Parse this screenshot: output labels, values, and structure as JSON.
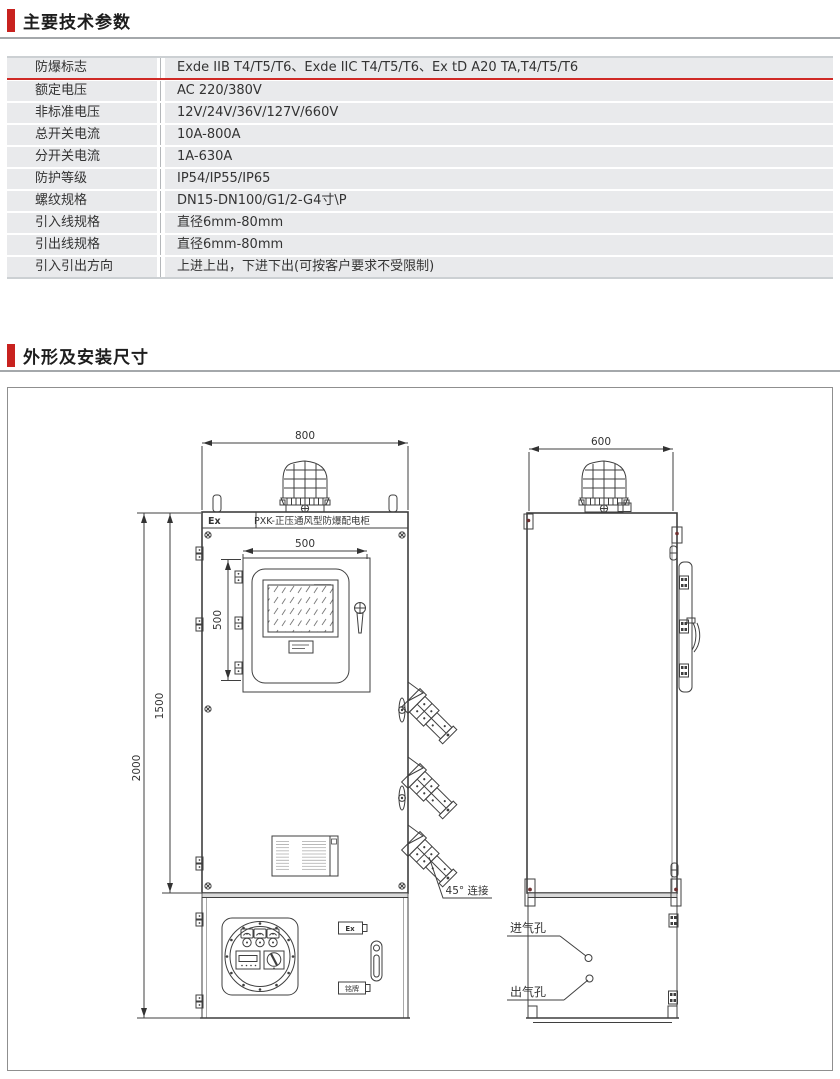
{
  "colors": {
    "accent_red": "#c8221f",
    "row_bg": "#e9eaec",
    "line": "#3f3f3f"
  },
  "section1": {
    "title": "主要技术参数"
  },
  "section2": {
    "title": "外形及安装尺寸"
  },
  "spec_table": {
    "rows": [
      {
        "label": "防爆标志",
        "value": "Exde IIB T4/T5/T6、Exde IIC T4/T5/T6、Ex tD  A20 TA,T4/T5/T6"
      },
      {
        "label": "额定电压",
        "value": "AC 220/380V"
      },
      {
        "label": "非标准电压",
        "value": "12V/24V/36V/127V/660V"
      },
      {
        "label": "总开关电流",
        "value": "10A-800A"
      },
      {
        "label": "分开关电流",
        "value": "1A-630A"
      },
      {
        "label": "防护等级",
        "value": "IP54/IP55/IP65"
      },
      {
        "label": "螺纹规格",
        "value": "DN15-DN100/G1/2-G4寸\\P"
      },
      {
        "label": "引入线规格",
        "value": "直径6mm-80mm"
      },
      {
        "label": "引出线规格",
        "value": "直径6mm-80mm"
      },
      {
        "label": "引入引出方向",
        "value": "上进上出，下进下出(可按客户要求不受限制)"
      }
    ]
  },
  "drawing": {
    "front": {
      "dim_width": "800",
      "dim_door_width": "500",
      "dim_door_height": "500",
      "dim_body_height": "1500",
      "dim_total_height": "2000",
      "ex_mark": "Ex",
      "header_title": "PXK-正压通风型防爆配电柜",
      "note_45": "45° 连接",
      "badge_ex": "Ex",
      "badge_nameplate": "铭牌"
    },
    "side": {
      "dim_depth": "600",
      "inlet_label": "进气孔",
      "outlet_label": "出气孔"
    }
  }
}
